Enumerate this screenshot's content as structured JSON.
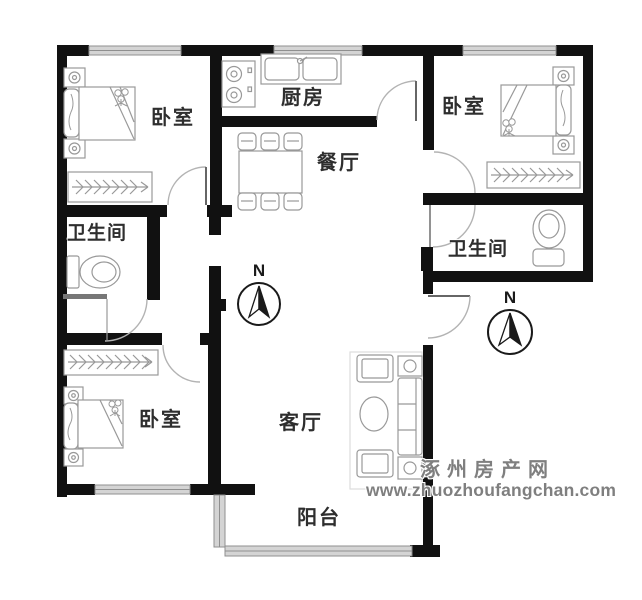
{
  "floorplan": {
    "type": "residential-floor-plan",
    "room_labels": [
      {
        "name": "bedroom-top-left",
        "label": "卧室"
      },
      {
        "name": "kitchen",
        "label": "厨房"
      },
      {
        "name": "dining-room",
        "label": "餐厅"
      },
      {
        "name": "bedroom-top-right",
        "label": "卧室"
      },
      {
        "name": "bathroom-left",
        "label": "卫生间"
      },
      {
        "name": "bathroom-right",
        "label": "卫生间"
      },
      {
        "name": "bedroom-bottom-left",
        "label": "卧室"
      },
      {
        "name": "living-room",
        "label": "客厅"
      },
      {
        "name": "balcony",
        "label": "阳台"
      }
    ],
    "compass_north_label": "N",
    "compass_count": 2,
    "watermark": {
      "line1": "涿州房产网",
      "line2": "www.zhuozhoufangchan.com"
    },
    "colors": {
      "wall": "#111111",
      "window_fill": "#d4d4d4",
      "window_stroke": "#8f8f8f",
      "furniture_stroke": "#999999",
      "door_arc": "#b3b3b3",
      "door_leaf": "#666666",
      "label_color": "#2e2e2e",
      "watermark_color": "#7f7f7f"
    }
  }
}
